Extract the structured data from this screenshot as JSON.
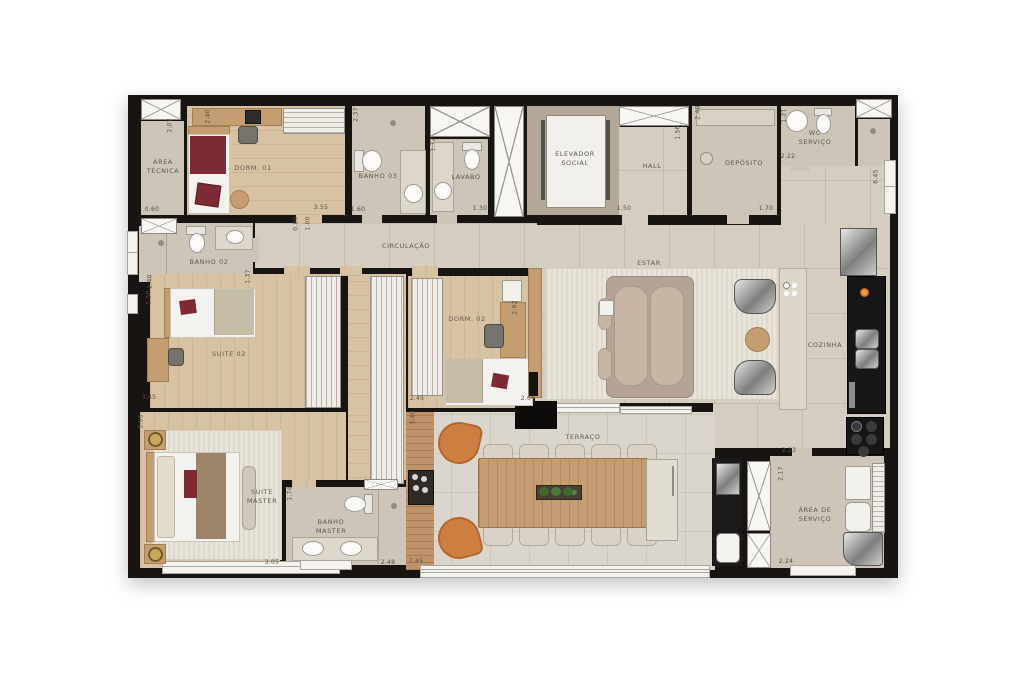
{
  "rooms": {
    "area_tecnica": "ÁREA TÉCNICA",
    "dorm_01": "DORM. 01",
    "banho_03": "BANHO 03",
    "lavabo": "LAVABO",
    "elevador": "ELEVADOR SOCIAL",
    "hall": "HALL",
    "deposito": "DEPÓSITO",
    "wc_servico": "WC SERVIÇO",
    "banho_02": "BANHO 02",
    "circulacao": "CIRCULAÇÃO",
    "suite_02": "SUITE 02",
    "dorm_02": "DORM. 02",
    "estar": "ESTAR",
    "cozinha": "COZINHA",
    "suite_master": "SUITE MASTER",
    "banho_master": "BANHO MASTER",
    "terraco": "TERRAÇO",
    "area_servico": "ÁREA DE SERVIÇO"
  },
  "dims": {
    "atecnica_h": "2.07",
    "atecnica_w": "0.60",
    "dorm01_h": "2.40",
    "dorm01_w": "3.55",
    "banho03_h": "2.37",
    "banho03_w": "1.60",
    "lavabo_h": "1.72",
    "lavabo_w": "1.30",
    "hall_w": "1.50",
    "hall_h": "1.56",
    "deposito_h": "2.48",
    "deposito_w": "1.70",
    "wc_h": "1.21",
    "wc_w": "2.22",
    "right_h": "6.45",
    "banho02_h": "2.40",
    "banho02_r": "1.37",
    "suite02_h": "2.50",
    "suite02_w": "3.45",
    "circ_door1": "0.80",
    "circ_door2": "1.00",
    "dorm02_w": "2.45",
    "dorm02_h": "2.92",
    "terr_door": "2.04",
    "terr_h": "3.40",
    "terr_w": "7.45",
    "smaster_h": "3.96",
    "smaster_w": "3.05",
    "bmaster_h": "1.74",
    "bmaster_w": "2.48",
    "serv_top": "2.23",
    "serv_h": "2.17",
    "serv_w": "2.24"
  },
  "colors": {
    "wall": "#171411",
    "wood_accent": "#c49d70",
    "terrace_chair_orange": "#cd7f42",
    "blanket_red": "#7d2b33",
    "counter_black": "#161616"
  }
}
